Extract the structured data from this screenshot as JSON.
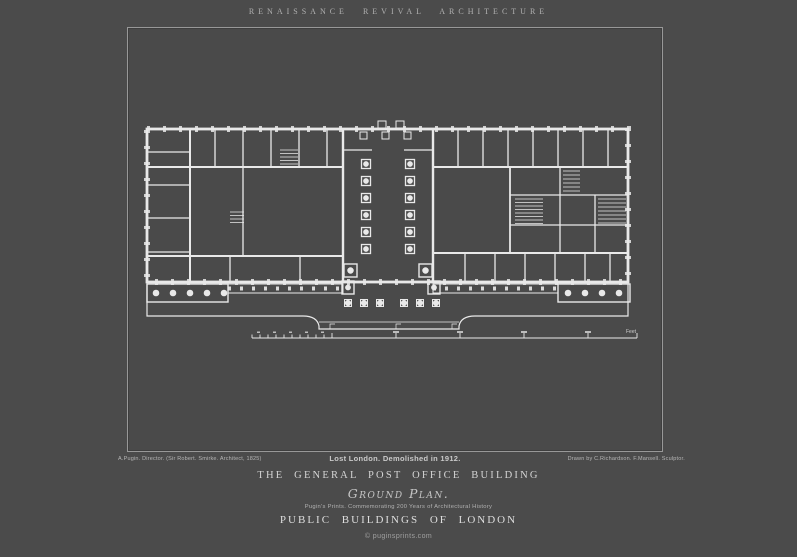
{
  "poster": {
    "banner": "RENAISSANCE REVIVAL ARCHITECTURE",
    "credits": {
      "left": "A.Pugin. Director. (Sir Robert. Smirke. Architect, 1825)",
      "center": "Lost London. Demolished in 1912.",
      "right": "Drawn by C.Richardson. F.Mansell. Sculptor."
    },
    "title": "THE GENERAL POST OFFICE BUILDING",
    "subtitle": "Ground Plan.",
    "tagline": "Pugin's Prints. Commemorating 200 Years of Architectural History",
    "series": "PUBLIC BUILDINGS OF LONDON",
    "footer": "© puginsprints.com",
    "plan": {
      "scale_label": "Feet"
    },
    "colors": {
      "background": "#4b4b4b",
      "frame_line": "#989898",
      "ink": "#e9e9e9",
      "title_text": "#d4d4d4",
      "muted_text": "#b2b2b2"
    }
  }
}
